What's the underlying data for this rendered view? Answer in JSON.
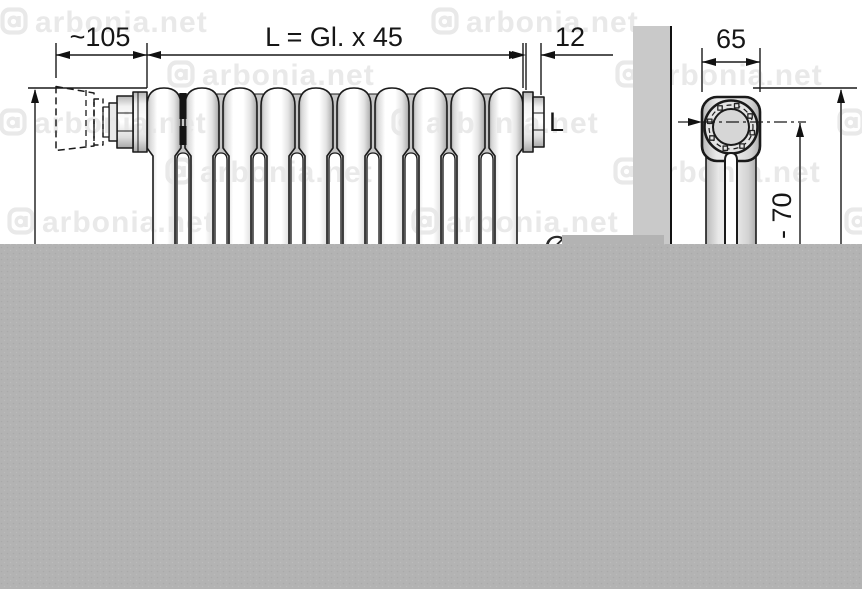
{
  "watermark": {
    "text": "arbonia.net",
    "color": "#e5e5e5",
    "logo": "arbonia-logo-icon"
  },
  "front_view": {
    "valve_length_label": "~105",
    "length_formula_label": "L = Gl. x 45",
    "end_offset_label": "12",
    "connection_label": "L",
    "tube_diameter_label": "Ø 25",
    "sections": 10
  },
  "side_view": {
    "depth_label": "65",
    "center_height_label": "- 70"
  },
  "colors": {
    "line": "#1a1a1a",
    "wall_fill": "#c9c9c9",
    "overlay_fill": "#b3b3b3",
    "back_tube_fill": "#c6c6c6"
  }
}
